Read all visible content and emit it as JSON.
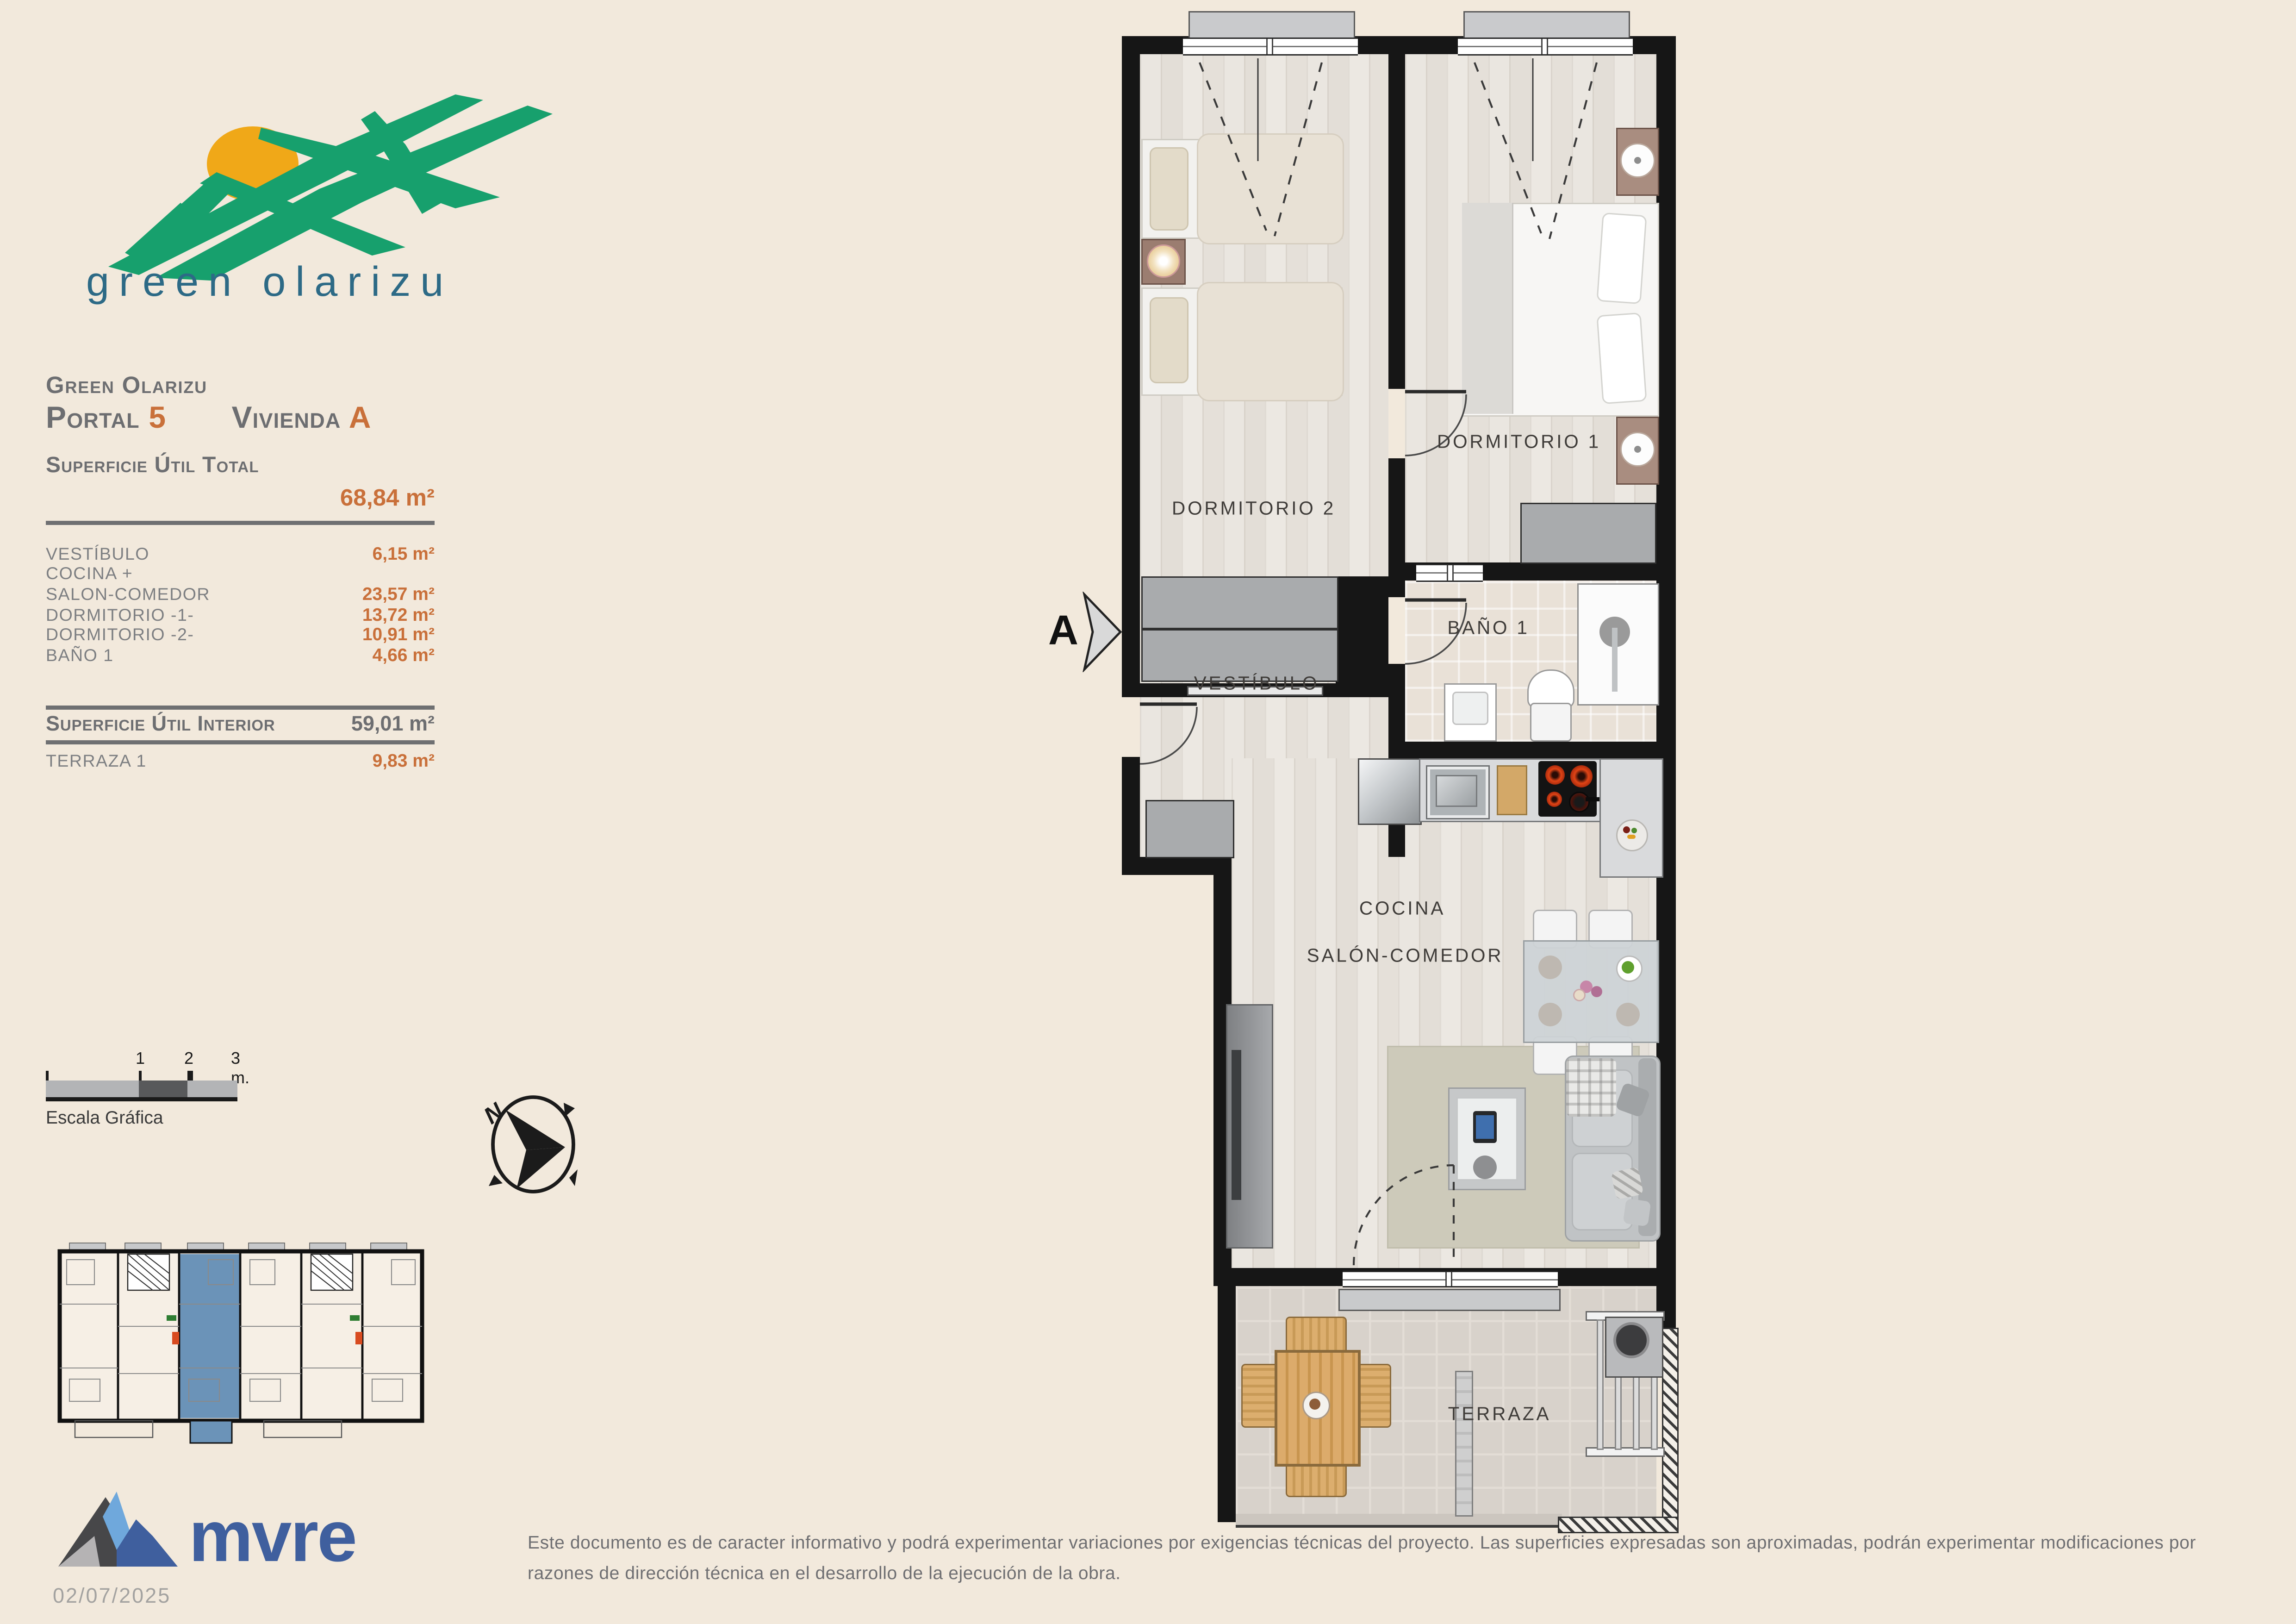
{
  "logo": {
    "brand": "green olarizu"
  },
  "header": {
    "project": "Green Olarizu",
    "portal_label": "Portal",
    "portal_value": "5",
    "vivienda_label": "Vivienda",
    "vivienda_value": "A"
  },
  "surface": {
    "total_label": "Superficie Útil Total",
    "total_value": "68,84 m²",
    "rows": [
      {
        "label": "VESTÍBULO",
        "value": "6,15 m²"
      },
      {
        "label": "COCINA +",
        "value": ""
      },
      {
        "label": "SALON-COMEDOR",
        "value": "23,57 m²"
      },
      {
        "label": "DORMITORIO -1-",
        "value": "13,72 m²"
      },
      {
        "label": "DORMITORIO -2-",
        "value": "10,91 m²"
      },
      {
        "label": "BAÑO 1",
        "value": "4,66 m²"
      }
    ],
    "interior_label": "Superficie Útil Interior",
    "interior_value": "59,01 m²",
    "terraza_label": "TERRAZA 1",
    "terraza_value": "9,83 m²"
  },
  "scalebar": {
    "tick0": "",
    "tick1": "1",
    "tick2": "2",
    "tick3": "3 m.",
    "caption": "Escala Gráfica"
  },
  "compass": {
    "north": "N"
  },
  "plan": {
    "section_marker": "A",
    "rooms": {
      "dorm2": "DORMITORIO 2",
      "dorm1": "DORMITORIO 1",
      "vestibulo": "VESTÍBULO",
      "bano": "BAÑO 1",
      "cocina": "COCINA",
      "salon": "SALÓN-COMEDOR",
      "terraza": "TERRAZA"
    }
  },
  "footer": {
    "brand": "mvre",
    "date": "02/07/2025",
    "disclaimer": "Este documento es de caracter informativo y podrá experimentar variaciones por exigencias técnicas del proyecto. Las superficies expresadas son aproximadas, podrán experimentar modificaciones por razones de dirección técnica en el desarrollo de la ejecución de la obra."
  },
  "colors": {
    "background": "#f2e9dc",
    "accent_orange": "#c9703a",
    "text_gray": "#6d6e71",
    "logo_green": "#17a06d",
    "logo_sun": "#f0a818",
    "logo_blue": "#2d6a86",
    "mvre_blue": "#3f5f9e",
    "keyplan_blue": "#6b93b8",
    "wall_black": "#161616"
  }
}
